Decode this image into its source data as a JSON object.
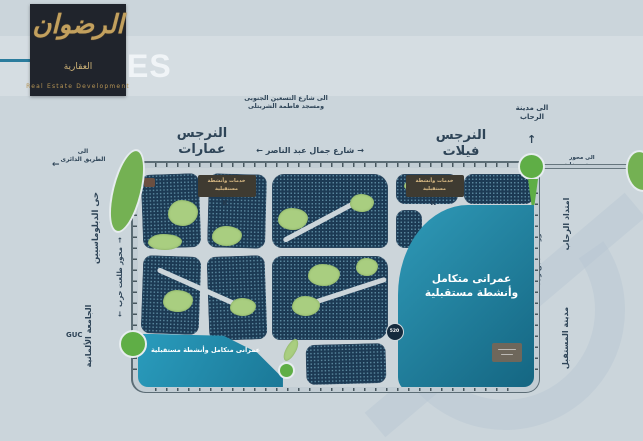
{
  "logo": {
    "brand_calligraphy": "الرضوان",
    "brand_word": "العقارية",
    "tagline": "Real Estate Development"
  },
  "header": {
    "partial_title": "ES"
  },
  "arrows": {
    "left": "←",
    "right": "→",
    "up": "↑"
  },
  "map_labels": {
    "to_south_90th_line1": "الى شارع التسعين الجنوبى",
    "to_south_90th_line2": "ومسجد فاطمة الشربتلى",
    "narges_apartments": "النرجس عمارات",
    "narges_villas": "النرجس فيلات",
    "gamal_abdel_nasser_street": "شارع جمال عبد الناصر",
    "to_ring_road_line1": "الى",
    "to_ring_road_line2": "الطريق الدائرى",
    "diplomats_district": "حى الدبلوماسيين",
    "talaat_harb_axis": "محور طلعت حرب",
    "german_university": "الجامعة الألمانية",
    "guc": "GUC",
    "to_rehab_city_line1": "الى مدينة",
    "to_rehab_city_line2": "الرحاب",
    "to_mbz_axis_line1": "الى محور",
    "to_mbz_axis_line2": "محمد بن زايد",
    "mbz_axis_road": "محور محمد بن زايد",
    "rehab_extension": "امتداد الرحاب",
    "mostakbal_city": "مدينة المستقبل",
    "services_banner_line1": "خدمات وأنشطة",
    "services_banner_line2": "مستقبلية",
    "k_marker": "K",
    "lake_zone_line1": "عمرانى متكامل",
    "lake_zone_line2": "وأنشطة مستقبلية",
    "bottom_zone": "عمرانى متكامل وأنشطة مستقبلية",
    "pin_badge": "520"
  },
  "colors": {
    "background": "#cbd5db",
    "logo_box": "#20242c",
    "gold": "#c2a05e",
    "accent_teal_line": "#2b7c9d",
    "housing_block": "#1c3a54",
    "park_green": "#a9ce80",
    "roundabout_green": "#5fae46",
    "lake_teal": "#1f82a3",
    "road_light": "#c2cdd4",
    "road_outline": "#5c6d76",
    "label_navy": "#2e4457",
    "banner_brown": "#3f3b31",
    "banner_text_gold": "#d9ba84"
  }
}
